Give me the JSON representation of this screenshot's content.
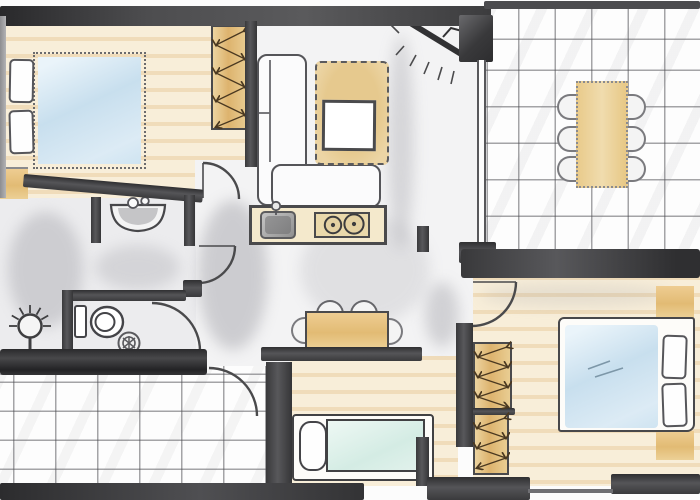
{
  "title": "hand-drawn apartment floor plan (no text labels in drawing)",
  "colors": {
    "paper": "#fcfcfc",
    "wood": "#f8eed9",
    "floor-light": "#f3f3f4",
    "floor-gray": "#ececee",
    "wash": "#9f9fa6",
    "wall-dark": "#2f2f31",
    "tan": "#e8c98c",
    "mattress-blue": "#cde2f0",
    "mattress-teal": "#d8eee7",
    "outline": "#4a4a4c"
  },
  "rooms": [
    {
      "id": "bedroom-top-left",
      "floor": "wood plank",
      "furniture": [
        "double-bed",
        "two-pillows",
        "wardrobe-zigzag",
        "corner-dresser"
      ]
    },
    {
      "id": "bathroom",
      "floor": "gray wash",
      "furniture": [
        "wash-basin",
        "two-tap-faucet"
      ]
    },
    {
      "id": "wc",
      "floor": "gray wash",
      "furniture": [
        "toilet",
        "floor-drain",
        "wall-lamp"
      ]
    },
    {
      "id": "utility-tiled-room",
      "floor": "large white tiles",
      "furniture": []
    },
    {
      "id": "living-kitchen",
      "floor": "light wash",
      "furniture": [
        "l-shaped-sofa",
        "area-rug",
        "coffee-table",
        "corner-tv",
        "kitchen-counter",
        "kitchen-sink",
        "two-burner-stove",
        "small-dining-table",
        "four-chairs"
      ]
    },
    {
      "id": "dining-room",
      "floor": "small white tiles",
      "furniture": [
        "dining-table",
        "six-chairs"
      ]
    },
    {
      "id": "bedroom-bottom-center",
      "floor": "wood plank",
      "furniture": [
        "single-bed",
        "pillow"
      ]
    },
    {
      "id": "bedroom-bottom-right",
      "floor": "wood plank",
      "furniture": [
        "double-bed",
        "two-pillows",
        "two-wardrobes-zigzag",
        "two-nightstands"
      ]
    }
  ],
  "doors": [
    {
      "id": "door-bedroom-top-left",
      "swing": "into bedroom"
    },
    {
      "id": "door-bathroom",
      "swing": "into hallway"
    },
    {
      "id": "door-wc",
      "swing": "into hallway"
    },
    {
      "id": "door-utility-room",
      "swing": "into tiled room"
    },
    {
      "id": "door-bedroom-bottom-right",
      "swing": "into bedroom"
    }
  ],
  "windows": [
    {
      "id": "opening-bottom-center-bedroom"
    },
    {
      "id": "window-bottom-right-bedroom"
    }
  ],
  "fixture_icons": [
    "toilet-icon",
    "sink-icon",
    "drain-icon",
    "lamp-icon",
    "tv-icon",
    "stove-burners-icon",
    "faucet-icon",
    "wardrobe-arrows-icon",
    "door-arc-icon"
  ]
}
